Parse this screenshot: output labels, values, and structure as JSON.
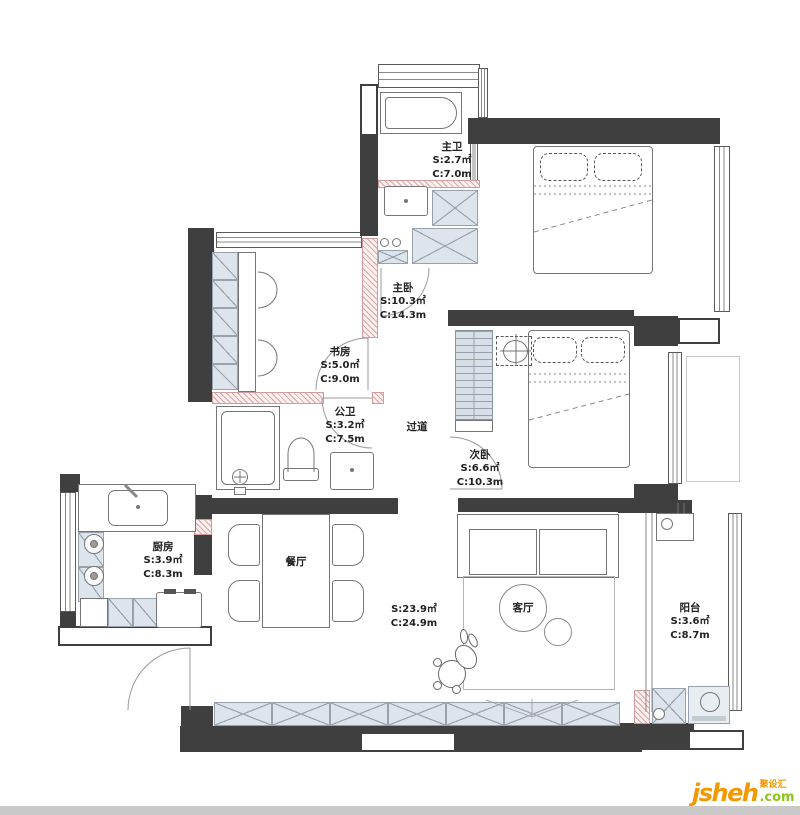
{
  "meta": {
    "type": "residential-floor-plan"
  },
  "colors": {
    "wall": "#3f3f3f",
    "cabinet_fill": "#dee4eb",
    "cabinet_line": "#98a2ae",
    "new_wall_hatch": "#cf9d9d",
    "furniture_line": "#767676",
    "brand_orange": "#f39800",
    "brand_green": "#8fc31f"
  },
  "rooms": [
    {
      "id": "master-bath",
      "name": "主卫",
      "area": "S:2.7㎡",
      "perimeter": "C:7.0m"
    },
    {
      "id": "master-bedroom",
      "name": "主卧",
      "area": "S:10.3㎡",
      "perimeter": "C:14.3m"
    },
    {
      "id": "study",
      "name": "书房",
      "area": "S:5.0㎡",
      "perimeter": "C:9.0m"
    },
    {
      "id": "public-bath",
      "name": "公卫",
      "area": "S:3.2㎡",
      "perimeter": "C:7.5m"
    },
    {
      "id": "hallway",
      "name": "过道",
      "area": "",
      "perimeter": ""
    },
    {
      "id": "second-bedroom",
      "name": "次卧",
      "area": "S:6.6㎡",
      "perimeter": "C:10.3m"
    },
    {
      "id": "kitchen",
      "name": "厨房",
      "area": "S:3.9㎡",
      "perimeter": "C:8.3m"
    },
    {
      "id": "dining",
      "name": "餐厅",
      "area": "",
      "perimeter": ""
    },
    {
      "id": "living-dining",
      "name": "",
      "area": "S:23.9㎡",
      "perimeter": "C:24.9m"
    },
    {
      "id": "living",
      "name": "客厅",
      "area": "",
      "perimeter": ""
    },
    {
      "id": "balcony",
      "name": "阳台",
      "area": "S:3.6㎡",
      "perimeter": "C:8.7m"
    }
  ],
  "watermark": {
    "brand": "jsheh",
    "tld": ".com",
    "cjk": "聚设汇"
  }
}
